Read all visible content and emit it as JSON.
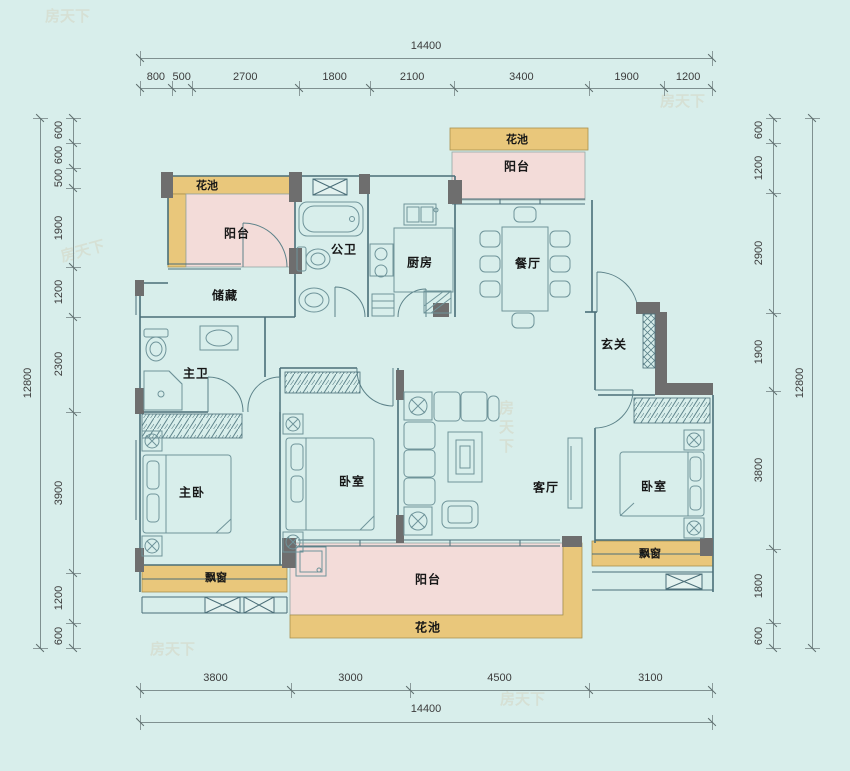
{
  "plan": {
    "watermark": "房天下",
    "rooms": {
      "flower_bed": "花池",
      "balcony": "阳台",
      "storage": "储藏",
      "public_bath": "公卫",
      "kitchen": "厨房",
      "dining": "餐厅",
      "foyer": "玄关",
      "master_bath": "主卫",
      "master_bed": "主卧",
      "bedroom": "卧室",
      "living": "客厅",
      "bay_window": "飘窗"
    },
    "colors": {
      "background": "#d8eeeb",
      "flower_bed": "#e9c77b",
      "balcony_pink": "#f3dcd9",
      "bay_window_tan": "#e9c77b",
      "wall_dark": "#6e6e6e",
      "line_teal": "#4a6e78"
    }
  },
  "dimensions": {
    "top": {
      "total": "14400",
      "segments": [
        "800",
        "500",
        "2700",
        "1800",
        "2100",
        "3400",
        "1900",
        "1200"
      ]
    },
    "bottom": {
      "total": "14400",
      "segments": [
        "3800",
        "3000",
        "4500",
        "3100"
      ]
    },
    "left": {
      "total": "12800",
      "segments": [
        "600",
        "600",
        "500",
        "1900",
        "1200",
        "2300",
        "3900",
        "1200",
        "600"
      ]
    },
    "right": {
      "total": "12800",
      "segments": [
        "600",
        "1200",
        "2900",
        "1900",
        "3800",
        "1800",
        "600"
      ]
    }
  }
}
